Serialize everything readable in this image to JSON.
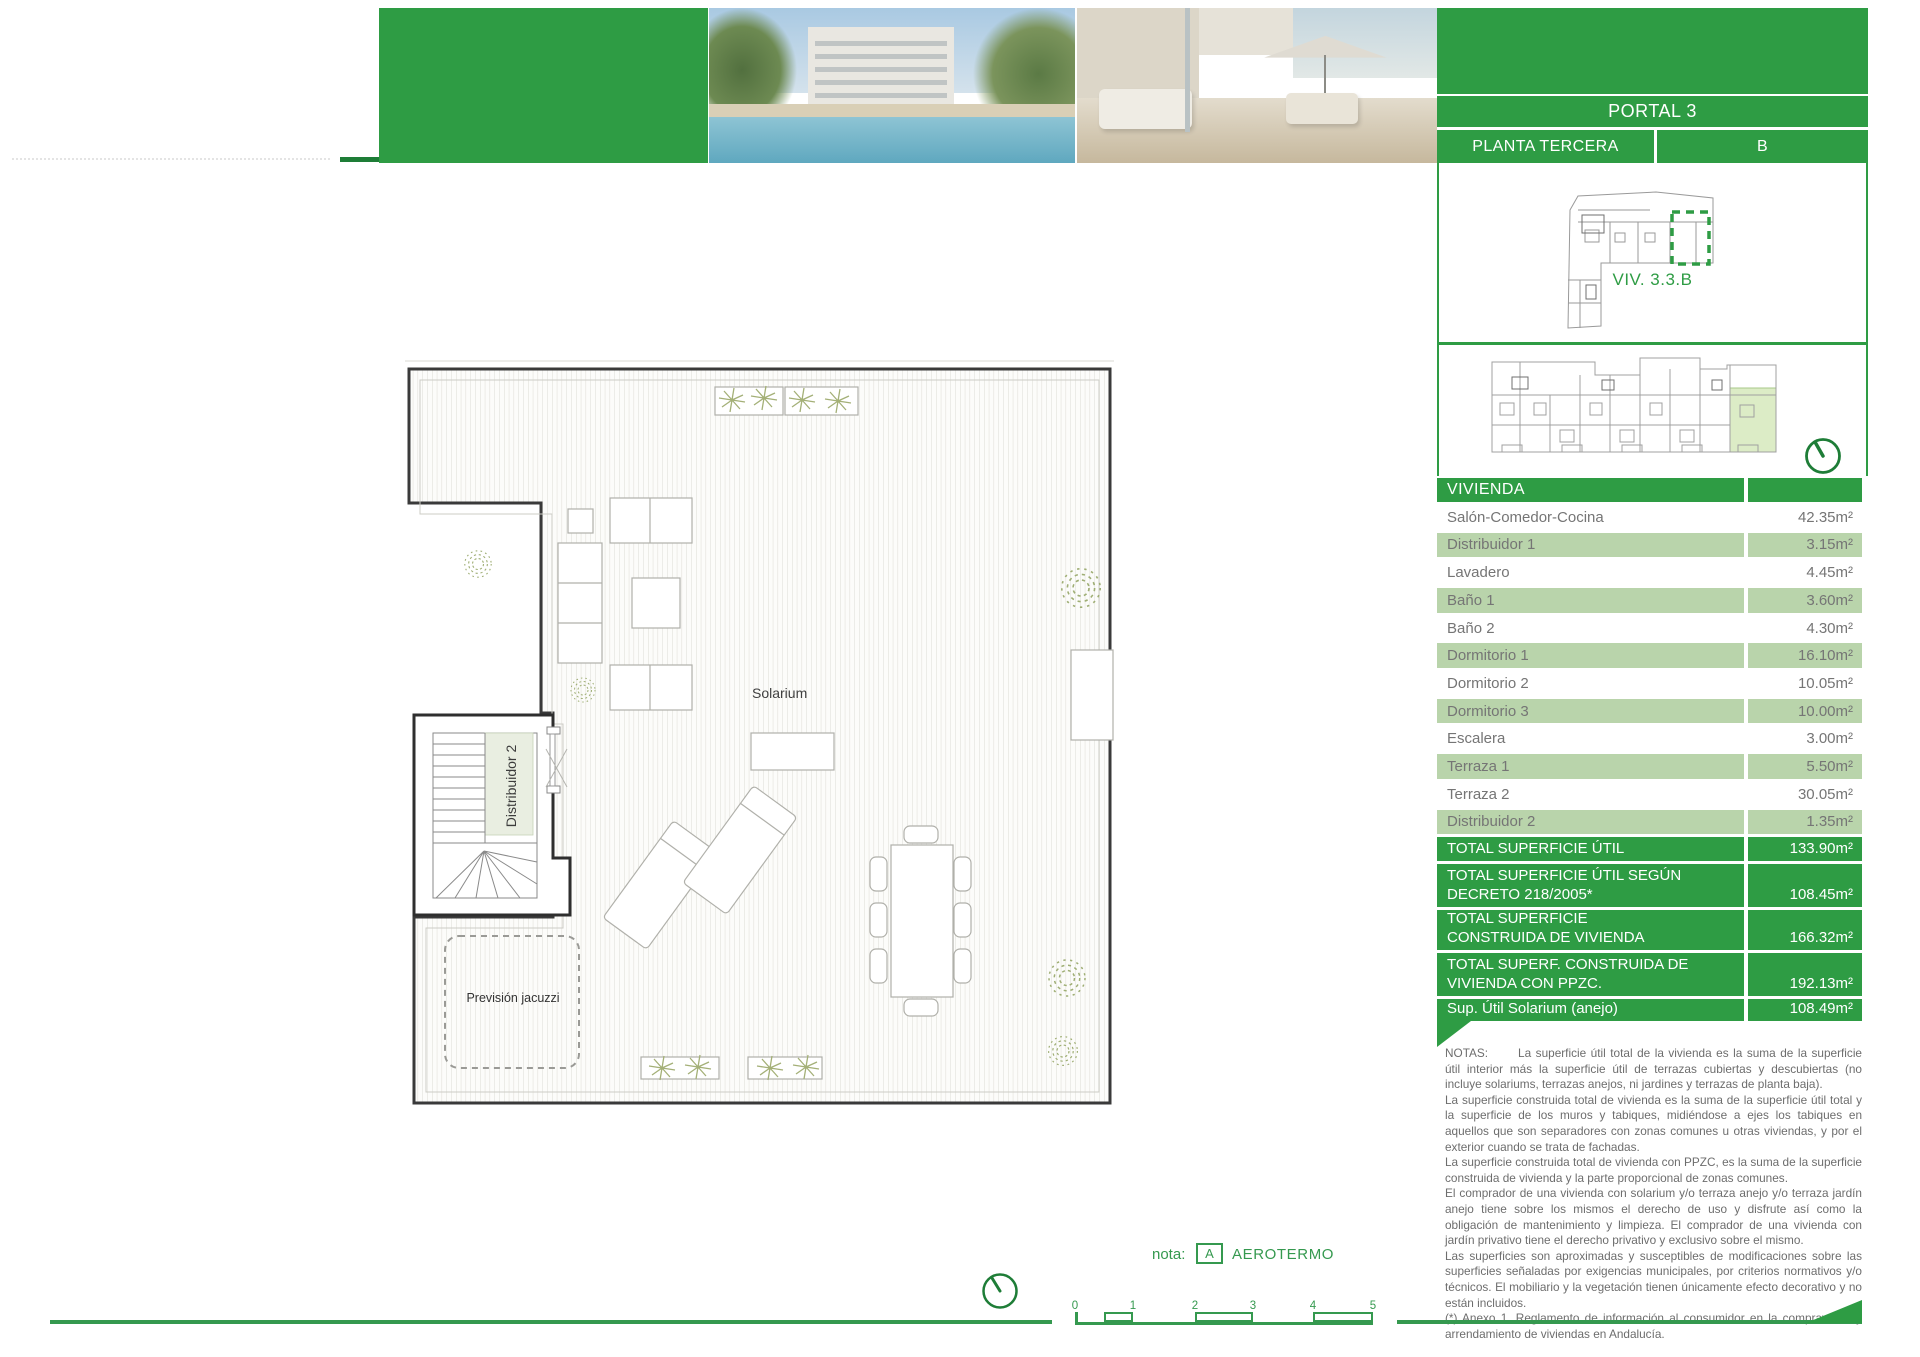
{
  "colors": {
    "green": "#2e9c44",
    "green-dark": "#1e7d37",
    "green-mid": "#35994f",
    "row-green": "#b9d4ab",
    "highlight-green": "#dcecc6",
    "text-grey": "#6d6d6d"
  },
  "header": {
    "portal": "PORTAL 3",
    "planta": "PLANTA TERCERA",
    "letter": "B",
    "photos": [
      "pool-garden-building-render",
      "rooftop-terrace-render"
    ]
  },
  "unit_label": "VIV. 3.3.B",
  "table": {
    "title": "VIVIENDA",
    "rows": [
      {
        "label": "Salón-Comedor-Cocina",
        "value": "42.35m²",
        "shaded": false
      },
      {
        "label": "Distribuidor 1",
        "value": "3.15m²",
        "shaded": true
      },
      {
        "label": "Lavadero",
        "value": "4.45m²",
        "shaded": false
      },
      {
        "label": "Baño 1",
        "value": "3.60m²",
        "shaded": true
      },
      {
        "label": "Baño 2",
        "value": "4.30m²",
        "shaded": false
      },
      {
        "label": "Dormitorio 1",
        "value": "16.10m²",
        "shaded": true
      },
      {
        "label": "Dormitorio 2",
        "value": "10.05m²",
        "shaded": false
      },
      {
        "label": "Dormitorio 3",
        "value": "10.00m²",
        "shaded": true
      },
      {
        "label": "Escalera",
        "value": "3.00m²",
        "shaded": false
      },
      {
        "label": "Terraza 1",
        "value": "5.50m²",
        "shaded": true
      },
      {
        "label": "Terraza 2",
        "value": "30.05m²",
        "shaded": false
      },
      {
        "label": "Distribuidor 2",
        "value": "1.35m²",
        "shaded": true
      }
    ],
    "totals": [
      {
        "label": "TOTAL SUPERFICIE ÚTIL",
        "value": "133.90m²"
      },
      {
        "label": "TOTAL SUPERFICIE ÚTIL SEGÚN\nDECRETO 218/2005*",
        "value": "108.45m²"
      },
      {
        "label": "TOTAL SUPERFICIE\nCONSTRUIDA DE VIVIENDA",
        "value": "166.32m²"
      },
      {
        "label": "TOTAL SUPERF. CONSTRUIDA DE\nVIVIENDA CON PPZC.",
        "value": "192.13m²"
      },
      {
        "label": "Sup. Útil Solarium (anejo)",
        "value": "108.49m²"
      }
    ]
  },
  "notes": {
    "label": "NOTAS:",
    "intro": "La superficie útil total de la vivienda es la suma de la superficie útil interior más la superficie útil de terrazas cubiertas y descubiertas (no incluye solariums, terrazas anejos, ni jardines y terrazas de planta baja).",
    "more": [
      "La superficie construida total de vivienda es la suma de la superficie útil total y la superficie de los muros y tabiques, midiéndose a ejes los tabiques en aquellos que son separadores con zonas comunes u otras viviendas, y por el exterior cuando se trata de fachadas.",
      "La superficie construida total de vivienda con PPZC, es la suma de la superficie construida de vivienda y la parte proporcional de zonas comunes.",
      "El comprador de una vivienda con solarium y/o terraza anejo y/o terraza jardín anejo tiene sobre los mismos el derecho de uso y disfrute así como la obligación de mantenimiento y limpieza. El comprador de una vivienda con jardín privativo tiene el derecho privativo y exclusivo sobre el mismo.",
      "Las superficies son aproximadas y susceptibles de modificaciones sobre las superficies señaladas por exigencias municipales, por criterios normativos y/o técnicos. El mobiliario y la vegetación tienen únicamente efecto decorativo y no están incluidos.",
      " (*) Anexo 1. Reglamento de información al consumidor en la compraventa y arrendamiento de viviendas en Andalucía."
    ]
  },
  "plan_labels": {
    "solarium": "Solarium",
    "distribuidor": "Distribuidor 2",
    "jacuzzi": "Previsión jacuzzi"
  },
  "footer": {
    "nota_label": "nota:",
    "marker_letter": "A",
    "marker_text": "AEROTERMO",
    "scale_ticks": [
      "0",
      "1",
      "2",
      "3",
      "4",
      "5"
    ]
  }
}
